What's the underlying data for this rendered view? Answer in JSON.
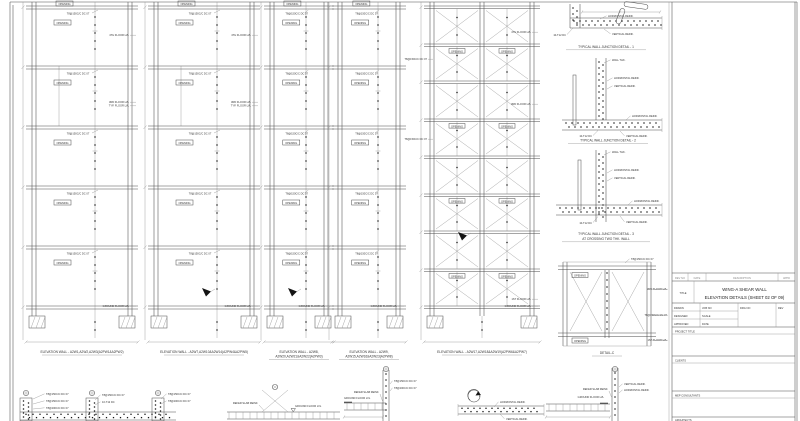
{
  "labels": {
    "opening": "OPENING",
    "tb150": "T8@150C/C DC 07",
    "tb200": "T8@200C/C DC 07",
    "lap_bar": "10-T12 DC",
    "horizontal_reinf": "HORIZONTAL REINF.",
    "vertical_reinf": "VERTICAL REINF.",
    "wall_thk": "WALL THK.",
    "refer_slab": "REFER SLAB REINF.",
    "ground_floor": "GROUND FLOOR LVL",
    "typ_floor": "TYP. FLOOR LVL",
    "first_floor": "1ST FLOOR LVL",
    "third_floor": "3RD FLOOR LVL",
    "fourth_floor": "4TH FLOOR LVL"
  },
  "elevations": [
    {
      "caption": "ELEVATION WALL - A2W1,A2W2,A2W3(A2PW1&A2PW2)"
    },
    {
      "caption": "ELEVATION WALL - A2W7,A2W10&A2W14(A2PW4&A2PW5)"
    },
    {
      "caption": "ELEVATION WALL - A2W8,",
      "caption2": "A2W20,A2W21&A2W22(A2PW3)"
    },
    {
      "caption": "ELEVATION WALL - A2W9,",
      "caption2": "A2W15,A2W16&A2W23(A2PW8)"
    },
    {
      "caption": "ELEVATION WALL - A2W17,A2W18&A2W19(A2PW6&A2PW7)"
    }
  ],
  "junction_details": [
    {
      "caption": "TYPICAL WALL JUNCTION DETAIL - 1"
    },
    {
      "caption": "TYPICAL WALL JUNCTION DETAIL - 2"
    },
    {
      "caption": "TYPICAL WALL JUNCTION DETAIL - 3",
      "caption2": "AT CROSSING TWO THK. WALL"
    }
  ],
  "detail_c": {
    "caption": "DETAIL-C"
  },
  "title_block": {
    "rev_no": "REV NO",
    "date": "DATE",
    "description": "DESCRIPTION",
    "appd": "APPD",
    "title_label": "TITLE",
    "title_line1": "WING-A SHEAR WALL",
    "title_line2": "ELEVATION DETAILS (SHEET 02 OF 09)",
    "drawn": "DRAWN",
    "job_no": "JOB NO",
    "drg_no": "DRG NO",
    "rev": "REV",
    "designed": "DESIGNED",
    "scale": "SCALE",
    "approved": "APPROVED",
    "date2": "DATE",
    "project_title": "PROJECT TITLE",
    "clients": "CLIENTS",
    "mep": "MEP CONSULTANTS",
    "architects": "ARCHITECTS"
  }
}
